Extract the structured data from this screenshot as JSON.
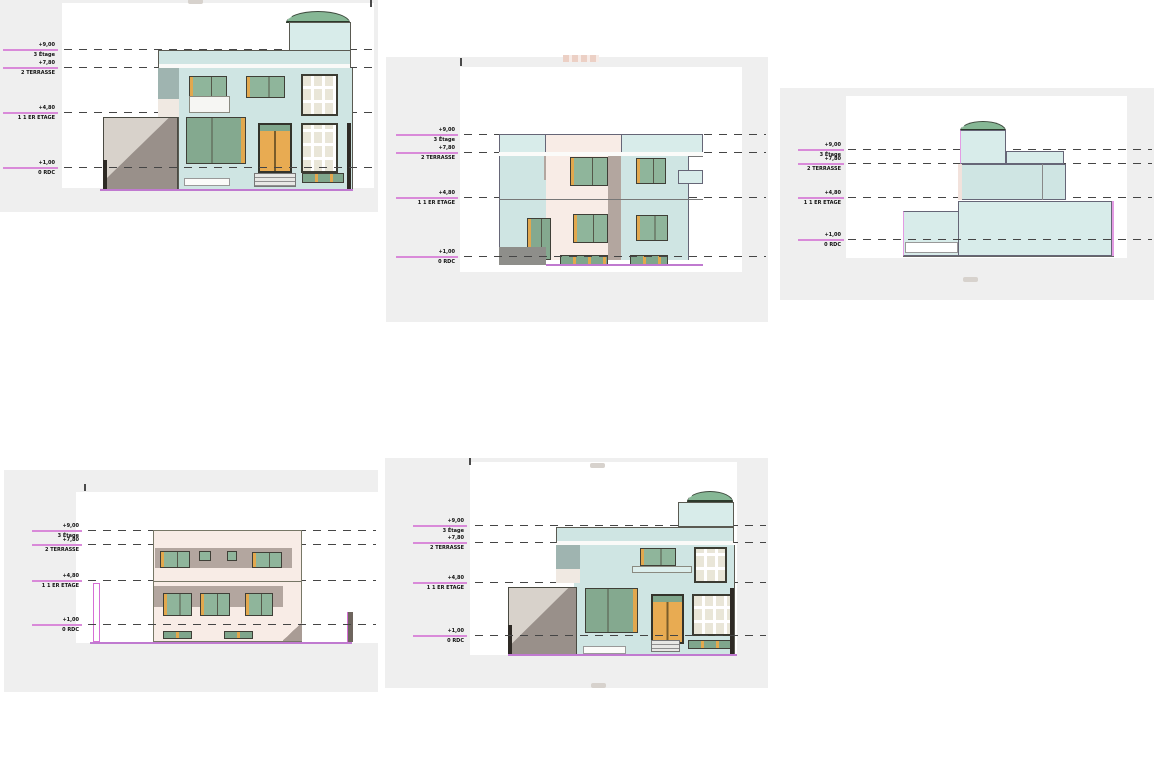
{
  "drawing": {
    "type": "architectural-elevations",
    "view_count": 5
  },
  "levels": [
    {
      "value": "+9,00",
      "name": "3 Étage"
    },
    {
      "value": "+7,80",
      "name": "2 TERRASSE"
    },
    {
      "value": "+4,80",
      "name": "1 1 ER ETAGE"
    },
    {
      "value": "+1,00",
      "name": "0 RDC"
    }
  ],
  "colors": {
    "page_background": "#ffffff",
    "sheet_background": "#efefef",
    "wall_blue": "#cfe5e3",
    "wall_pink": "#f8ece6",
    "shadow_gray": "#b3a69f",
    "garage_light": "#d8d2cb",
    "garage_dark": "#99908a",
    "dome_green": "#86b795",
    "glass_green": "#8fb59b",
    "frame_orange": "#e2a84e",
    "level_datum_magenta": "#d98ad9",
    "dashed_line": "#454545",
    "base_line_purple": "#c07ad0"
  }
}
